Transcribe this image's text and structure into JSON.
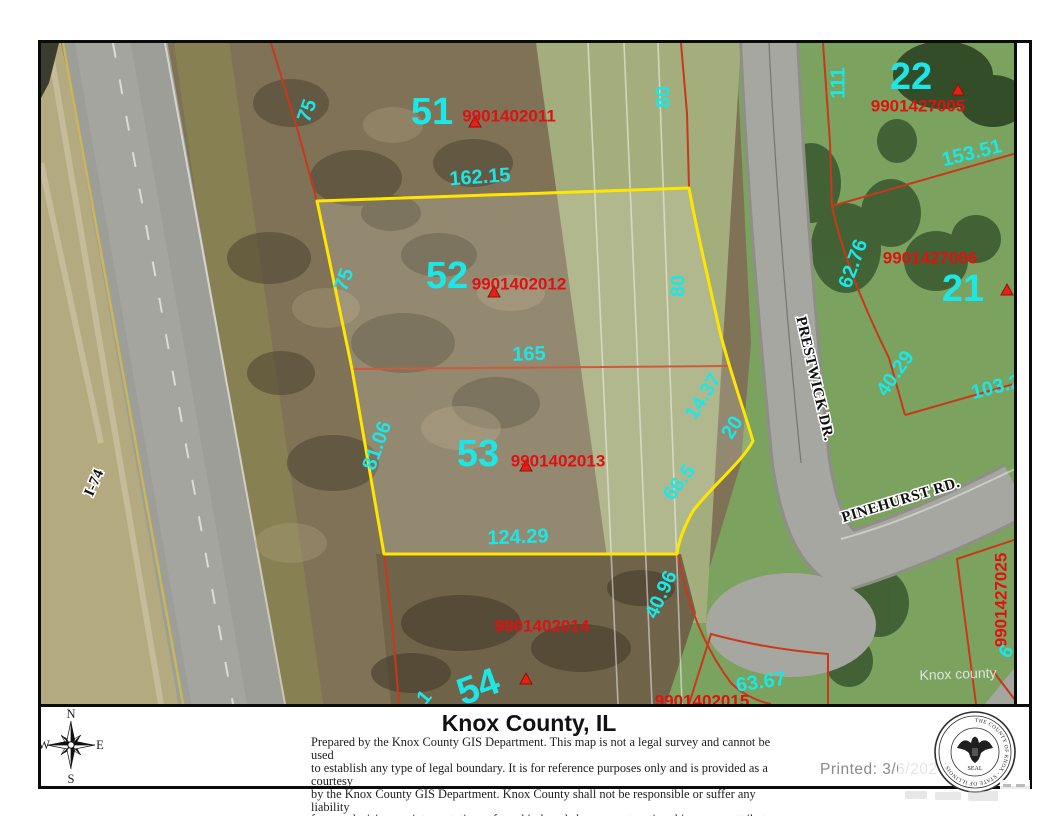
{
  "map": {
    "nums": {
      "n51": "51",
      "n52": "52",
      "n53": "53",
      "n54": "54",
      "n21": "21",
      "n22": "22"
    },
    "ids": {
      "p2011": "9901402011",
      "p2012": "9901402012",
      "p2013": "9901402013",
      "p2014": "9901402014",
      "p7005": "9901427005",
      "p7006": "9901427006",
      "p7025": "9901427025",
      "p2015": "9901402015"
    },
    "dims": {
      "d75a": "75",
      "d16215": "162.15",
      "d80a": "80",
      "d111": "111",
      "d15351": "153.51",
      "d6276": "62.76",
      "d75b": "75",
      "d80b": "80",
      "d165": "165",
      "d4029": "40.29",
      "d1032": "103.2",
      "d8106": "81.06",
      "d1437": "14.37",
      "d20": "20",
      "d665": "66.5",
      "d12429": "124.29",
      "d4096": "40.96",
      "d6367": "63.67",
      "d6": "6",
      "d1": "1"
    },
    "streets": {
      "i74": "I-74",
      "prestwick": "PRESTWICK DR.",
      "pinehurst": "PINEHURST RD."
    },
    "watermark": "Knox county"
  },
  "footer": {
    "compass": {
      "n": "N",
      "e": "E",
      "s": "S",
      "w": "W"
    },
    "title": "Knox County, IL",
    "disclaimer1": "Prepared by the Knox County GIS Department. This map is not a legal survey and cannot be used",
    "disclaimer2": "to establish any type of legal boundary. It is for reference purposes only and is provided as a courtesy",
    "disclaimer3": "by the Knox County GIS Department.  Knox County shall not be responsible or suffer any liability",
    "disclaimer4": "for any decisions or interpretations of any kind made by any party using this map or attribute data.",
    "printed": "Printed: 3/6/2026",
    "seal_ring": "THE COUNTY OF KNOX · STATE OF ILLINOIS ·",
    "seal_label": "SEAL"
  },
  "colors": {
    "parcel_highlight": "#ffe600",
    "dimension_text": "#1ce6e6",
    "parcel_id_text": "#e01111",
    "boundary_line": "#c8381a"
  }
}
